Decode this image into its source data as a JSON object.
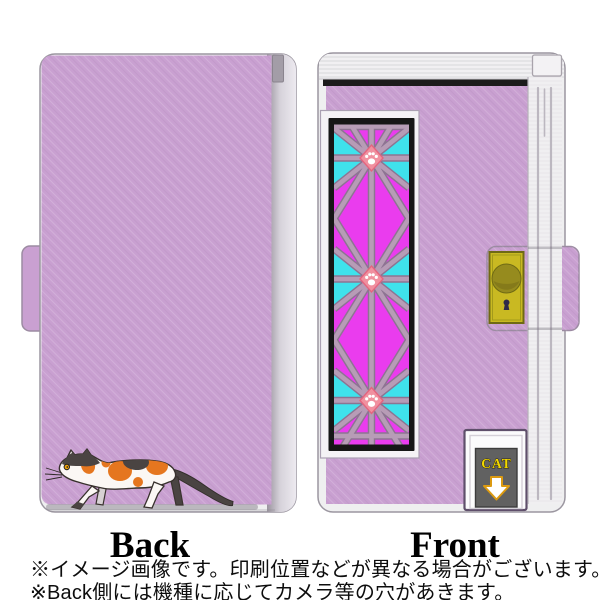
{
  "labels": {
    "back": "Back",
    "front": "Front"
  },
  "captions": {
    "line1": "※イメージ画像です。印刷位置などが異なる場合がございます。",
    "line2": "※Back側には機種に応じてカメラ等の穴があきます。"
  },
  "front_case": {
    "flap_label": "CAT"
  },
  "icons": {
    "paw_print": "paw-print-icon",
    "down_arrow": "down-arrow-icon",
    "doorknob": "doorknob-icon",
    "keyhole": "keyhole-icon"
  },
  "colors": {
    "lavender": "#c9a0d1",
    "magenta": "#ea3cee",
    "cyan": "#3fe2ec",
    "strip": "#b79cb6",
    "strip-edge": "#8d7492",
    "paw-pink": "#f0909f",
    "paw-edge": "#e4647f",
    "panel-black": "#161616",
    "black-strip": "#1b1b1b",
    "clasp-yellow": "#c9b922",
    "clasp-edge": "#6f6a14",
    "knob-olive": "#968b1e",
    "flap-gray": "#616161",
    "cat-label-yellow": "#f2d800",
    "arrow-orange": "#dc9a10",
    "cat-orange": "#e5761f",
    "cat-dark": "#4a4442",
    "edge-white": "#efeff0",
    "outline-gray": "#9b96a0"
  }
}
